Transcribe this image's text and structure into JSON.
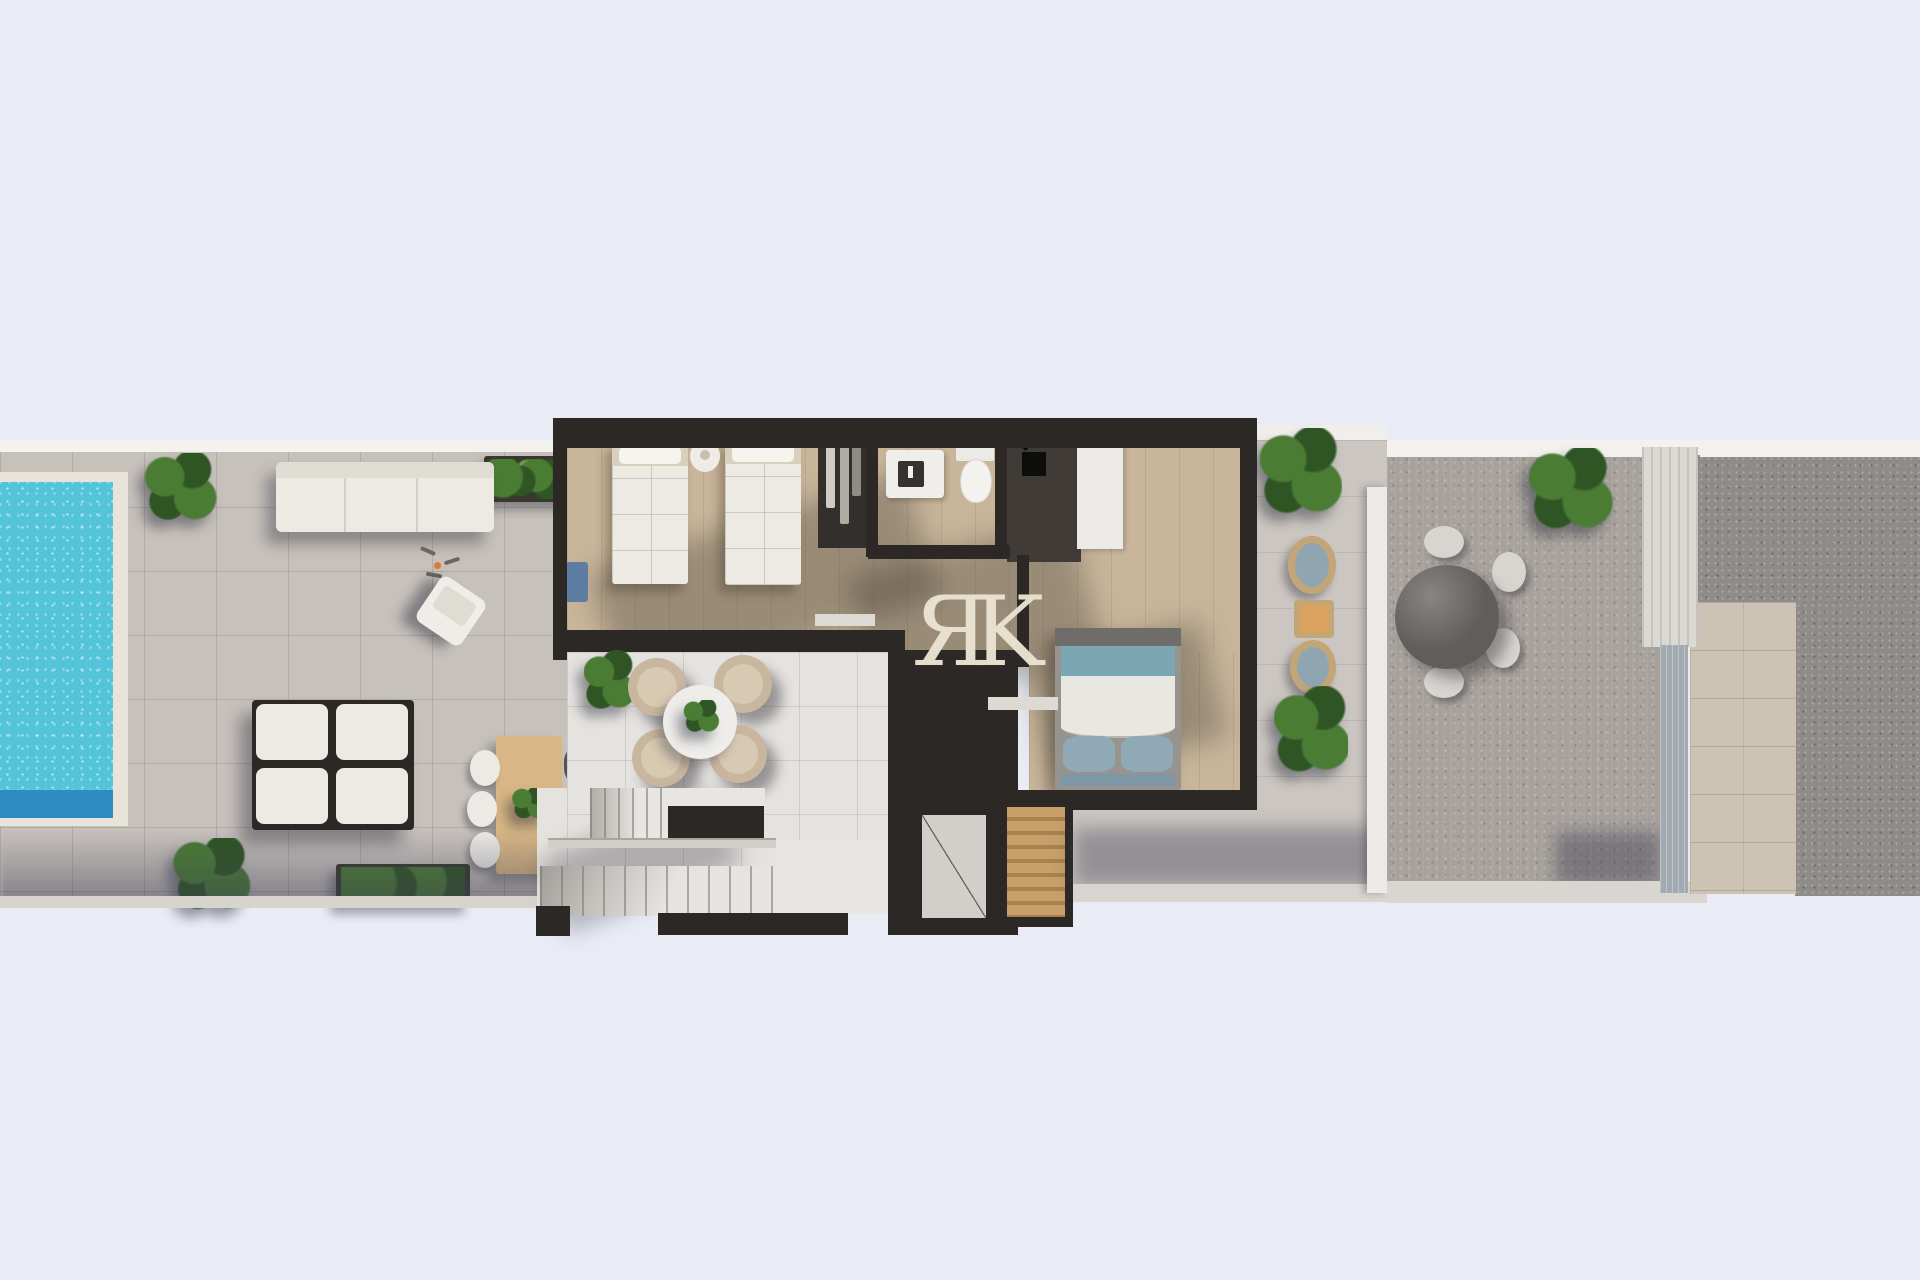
{
  "meta": {
    "type": "3d-floor-plan-top-down-render",
    "description": "Aerial 3D render of an apartment floor plan: pool terrace with loungers on the left, interior rooms (twin bedroom, wardrobe, bathroom, shower, master bedroom) in the centre, a stair courtyard with lounge set and staircases, a balcony with rattan chairs, a neighbouring terrace with a round table, and a gravel side passage on the right."
  },
  "watermark": {
    "letter_1": "Я",
    "letter_2": "K"
  },
  "icons": {
    "extractor_fan": "✻"
  },
  "colors": {
    "bg": "#e9ecf5",
    "terraceTile": "#c7c1bc",
    "terraceEdge": "#f3f2ef",
    "courtTile": "#e5e3df",
    "wall": "#2b2825",
    "woodFloor": "#c8b59a",
    "bedWhite": "#edeae3",
    "bedHead": "#d8cfbc",
    "poolWater": "#54c5d8",
    "poolDeep": "#2f8cc2",
    "poolDeck": "#e9e4da",
    "plantDark": "#2f5524",
    "plantMid": "#4a7c34",
    "plantLight": "#6da04b",
    "planter": "#393830",
    "woodTable": "#d8b685",
    "chairTan": "#c8b69e",
    "chairDark": "#57544e",
    "chairWhite": "#eceae4",
    "masterTeal": "#7ba6b4",
    "masterPillow": "#90a9b7",
    "masterFoot": "#7e97a4",
    "masterFrame": "#97938e",
    "masterHead": "#6e6d6a",
    "shower": "#403b36",
    "voidGray": "#d2cfca",
    "slatA": "#c89f68",
    "slatB": "#aa8050",
    "balconyTile": "#cbc6c1",
    "neighbor": "#a7a19c",
    "roundTable": "#605d5a",
    "gravel": "#8f8b88",
    "stone": "#cdc3b5",
    "glass": "#a2abb1",
    "ribbed": "#dbd9d4",
    "divider": "#ecebe7",
    "watermark": "#eae3d2",
    "orangeTable": "#d9a35f",
    "rattan": "#c2a678",
    "cushionBlue": "#8fa6b2",
    "blueItem": "#5e7da3",
    "accentOrange": "#e07b2e"
  },
  "scene": {
    "zones": [
      {
        "name": "pool-terrace",
        "objects": [
          "swimming-pool",
          "potted-plant",
          "hedge-planter",
          "outdoor-sofa",
          "beach-towels",
          "lounge-chair",
          "sun-lounger-set",
          "potted-plant",
          "hedge-planter",
          "wooden-dining-table",
          "white-chairs",
          "dark-chairs"
        ]
      },
      {
        "name": "apartment-interior",
        "objects": [
          "twin-bed",
          "twin-bed",
          "nightstand",
          "wardrobe-niche",
          "washbasin",
          "toilet",
          "shower-room",
          "extractor-fan",
          "built-in-closet",
          "double-bed",
          "hallway"
        ]
      },
      {
        "name": "stair-courtyard",
        "objects": [
          "round-lounge-table",
          "tub-chairs",
          "potted-plant",
          "upper-stair-flight",
          "lower-stair-flight",
          "stair-landing",
          "void-marker",
          "timber-slat-stair"
        ]
      },
      {
        "name": "balcony",
        "objects": [
          "potted-plant",
          "rattan-chair",
          "side-table",
          "rattan-chair",
          "potted-plant",
          "divider-wall"
        ]
      },
      {
        "name": "neighbour-terrace",
        "objects": [
          "round-table",
          "terrace-chairs",
          "potted-plant"
        ]
      },
      {
        "name": "side-passage",
        "objects": [
          "ribbed-screen",
          "glass-divider",
          "stone-path",
          "gravel-bed"
        ]
      }
    ]
  }
}
